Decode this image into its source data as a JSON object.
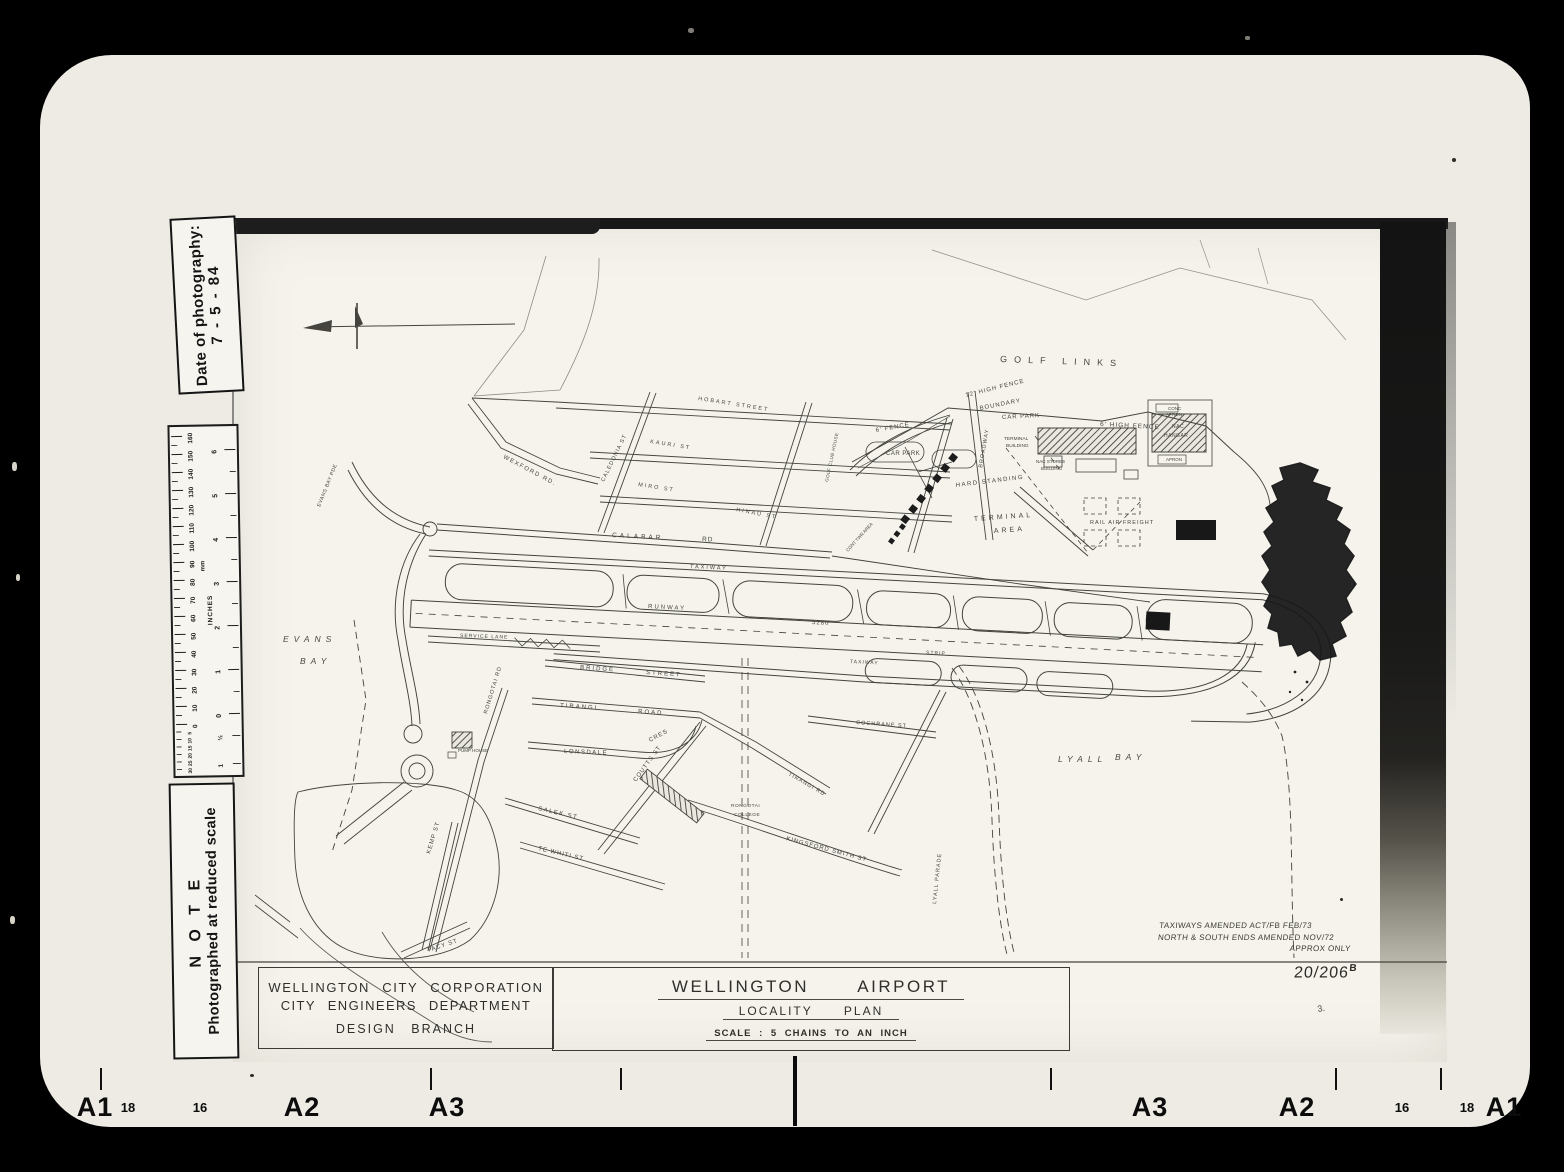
{
  "photo": {
    "date_sticker": {
      "line1": "Date of photography:",
      "line2": "7 - 5 - 84"
    },
    "note_sticker": {
      "line1": "N O T E",
      "line2": "Photographed at reduced scale"
    },
    "ruler": {
      "unit_left": "mm",
      "unit_right": "INCHES",
      "mm_labels": [
        160,
        150,
        140,
        130,
        120,
        110,
        100,
        90,
        80,
        70,
        60,
        50,
        40,
        30,
        20,
        10,
        0
      ],
      "mm_extra": [
        5,
        10,
        15,
        20,
        25,
        30
      ],
      "inch_labels": [
        6,
        5,
        4,
        3,
        2,
        1,
        0
      ],
      "inch_extra": [
        "½",
        "1"
      ]
    },
    "edge_markers": [
      {
        "text": "A1",
        "x": 95,
        "big": true
      },
      {
        "text": "18",
        "x": 128,
        "big": false
      },
      {
        "text": "16",
        "x": 200,
        "big": false
      },
      {
        "text": "A2",
        "x": 302,
        "big": true
      },
      {
        "text": "A3",
        "x": 447,
        "big": true
      },
      {
        "text": "A3",
        "x": 1150,
        "big": true
      },
      {
        "text": "A2",
        "x": 1297,
        "big": true
      },
      {
        "text": "16",
        "x": 1402,
        "big": false
      },
      {
        "text": "18",
        "x": 1467,
        "big": false
      },
      {
        "text": "A1",
        "x": 1504,
        "big": true
      }
    ]
  },
  "title_block": {
    "org_line1": "WELLINGTON CITY CORPORATION",
    "org_line2": "CITY ENGINEERS DEPARTMENT",
    "org_line3": "DESIGN BRANCH",
    "title": "WELLINGTON AIRPORT",
    "subtitle": "LOCALITY PLAN",
    "scale": "SCALE : 5 CHAINS TO AN INCH",
    "drawing_number": "20/206",
    "drawing_rev": "B",
    "amendment_1": "TAXIWAYS AMENDED ACT/FB FEB/73",
    "amendment_2": "NORTH & SOUTH ENDS AMENDED NOV/72",
    "amendment_3": "APPROX ONLY"
  },
  "map": {
    "labels": [
      {
        "t": "GOLF LINKS",
        "x": 1000,
        "y": 362,
        "r": 2,
        "s": 9,
        "ls": 7
      },
      {
        "t": "12' HIGH FENCE",
        "x": 966,
        "y": 397,
        "r": -14,
        "s": 6,
        "ls": 1
      },
      {
        "t": "BOUNDARY",
        "x": 980,
        "y": 410,
        "r": -11,
        "s": 6,
        "ls": 1
      },
      {
        "t": "CAR PARK",
        "x": 1002,
        "y": 419,
        "r": -3,
        "s": 6,
        "ls": 1
      },
      {
        "t": "6' FENCE",
        "x": 876,
        "y": 432,
        "r": -10,
        "s": 6,
        "ls": 1
      },
      {
        "t": "CAR PARK",
        "x": 886,
        "y": 455,
        "r": 0,
        "s": 6,
        "ls": 0.5
      },
      {
        "t": "6' HIGH FENCE",
        "x": 1100,
        "y": 426,
        "r": 3,
        "s": 6.5,
        "ls": 1
      },
      {
        "t": "CONC",
        "x": 1168,
        "y": 410,
        "r": 0,
        "s": 4.5,
        "ls": 0
      },
      {
        "t": "APRON",
        "x": 1166,
        "y": 416,
        "r": 0,
        "s": 4.5,
        "ls": 0
      },
      {
        "t": "NAC",
        "x": 1172,
        "y": 428,
        "r": 0,
        "s": 5,
        "ls": 0.5
      },
      {
        "t": "HANGAR",
        "x": 1164,
        "y": 437,
        "r": 0,
        "s": 5,
        "ls": 0.5
      },
      {
        "t": "APRON",
        "x": 1166,
        "y": 461,
        "r": 0,
        "s": 4.5,
        "ls": 0
      },
      {
        "t": "TERMINAL",
        "x": 1004,
        "y": 440,
        "r": 0,
        "s": 4.8,
        "ls": 0
      },
      {
        "t": "BUILDING",
        "x": 1006,
        "y": 447,
        "r": 0,
        "s": 4.8,
        "ls": 0
      },
      {
        "t": "NAC STORES",
        "x": 1036,
        "y": 463,
        "r": 0,
        "s": 4.5,
        "ls": 0
      },
      {
        "t": "BUILDING",
        "x": 1041,
        "y": 470,
        "r": 0,
        "s": 4.5,
        "ls": 0
      },
      {
        "t": "HARD STANDING",
        "x": 956,
        "y": 487,
        "r": -7,
        "s": 6,
        "ls": 1.5
      },
      {
        "t": "TERMINAL",
        "x": 974,
        "y": 521,
        "r": -4,
        "s": 7,
        "ls": 3
      },
      {
        "t": "AREA",
        "x": 994,
        "y": 533,
        "r": -4,
        "s": 7,
        "ls": 3
      },
      {
        "t": "RAIL AIR FREIGHT",
        "x": 1090,
        "y": 524,
        "r": 0,
        "s": 5.5,
        "ls": 1
      },
      {
        "t": "GOLF CLUB HOUSE",
        "x": 828,
        "y": 482,
        "r": -78,
        "s": 4.5,
        "ls": 0.5
      },
      {
        "t": "CONT TWR AREA",
        "x": 848,
        "y": 552,
        "r": -48,
        "s": 4.5,
        "ls": 0
      },
      {
        "t": "CALABAR",
        "x": 612,
        "y": 537,
        "r": 3,
        "s": 6.5,
        "ls": 3
      },
      {
        "t": "RD",
        "x": 702,
        "y": 541,
        "r": 3,
        "s": 6.5,
        "ls": 1
      },
      {
        "t": "TAXIWAY",
        "x": 690,
        "y": 568,
        "r": 3,
        "s": 5.5,
        "ls": 2
      },
      {
        "t": "RUNWAY",
        "x": 648,
        "y": 608,
        "r": 3,
        "s": 6,
        "ls": 2
      },
      {
        "t": "5280",
        "x": 812,
        "y": 624,
        "r": 3,
        "s": 6,
        "ls": 1
      },
      {
        "t": "TAXIWAY",
        "x": 850,
        "y": 663,
        "r": 3,
        "s": 5,
        "ls": 1
      },
      {
        "t": "STRIP",
        "x": 926,
        "y": 654,
        "r": 3,
        "s": 5,
        "ls": 1
      },
      {
        "t": "EVANS",
        "x": 283,
        "y": 642,
        "r": 0,
        "s": 8.5,
        "ls": 5,
        "i": true
      },
      {
        "t": "BAY",
        "x": 300,
        "y": 664,
        "r": 0,
        "s": 8.5,
        "ls": 5,
        "i": true
      },
      {
        "t": "LYALL",
        "x": 1058,
        "y": 762,
        "r": 0,
        "s": 8.5,
        "ls": 5,
        "i": true
      },
      {
        "t": "BAY",
        "x": 1115,
        "y": 760,
        "r": 0,
        "s": 8.5,
        "ls": 5,
        "i": true
      },
      {
        "t": "SERVICE LANE",
        "x": 460,
        "y": 637,
        "r": 2,
        "s": 5,
        "ls": 1
      },
      {
        "t": "BRIDGE",
        "x": 580,
        "y": 669,
        "r": 4,
        "s": 6,
        "ls": 2
      },
      {
        "t": "STREET",
        "x": 646,
        "y": 674,
        "r": 4,
        "s": 6,
        "ls": 2
      },
      {
        "t": "TIRANGI",
        "x": 560,
        "y": 707,
        "r": 4,
        "s": 6,
        "ls": 2
      },
      {
        "t": "ROAD",
        "x": 638,
        "y": 713,
        "r": 4,
        "s": 6,
        "ls": 2
      },
      {
        "t": "LONSDALE",
        "x": 564,
        "y": 753,
        "r": 2,
        "s": 6,
        "ls": 1.5
      },
      {
        "t": "CRES",
        "x": 650,
        "y": 742,
        "r": -28,
        "s": 6,
        "ls": 1
      },
      {
        "t": "COUTTS ST",
        "x": 636,
        "y": 782,
        "r": -54,
        "s": 6,
        "ls": 1
      },
      {
        "t": "SALEK ST",
        "x": 538,
        "y": 810,
        "r": 13,
        "s": 6,
        "ls": 1.5
      },
      {
        "t": "TE WHITI ST",
        "x": 538,
        "y": 850,
        "r": 13,
        "s": 6,
        "ls": 1
      },
      {
        "t": "KEMP ST",
        "x": 430,
        "y": 854,
        "r": -73,
        "s": 6,
        "ls": 1
      },
      {
        "t": "TACY ST",
        "x": 428,
        "y": 952,
        "r": -18,
        "s": 6,
        "ls": 1
      },
      {
        "t": "RONGOTAI RD",
        "x": 487,
        "y": 714,
        "r": -73,
        "s": 5.5,
        "ls": 1
      },
      {
        "t": "RONGOTAI",
        "x": 731,
        "y": 807,
        "r": 0,
        "s": 4.8,
        "ls": 0.5
      },
      {
        "t": "COLLEGE",
        "x": 734,
        "y": 816,
        "r": 0,
        "s": 4.8,
        "ls": 0.5
      },
      {
        "t": "KINGSFORD SMITH ST",
        "x": 786,
        "y": 840,
        "r": 15,
        "s": 6,
        "ls": 1
      },
      {
        "t": "COCHRANE ST",
        "x": 856,
        "y": 724,
        "r": 4,
        "s": 5.5,
        "ls": 1
      },
      {
        "t": "TIRANGI RD",
        "x": 788,
        "y": 775,
        "r": 30,
        "s": 5.5,
        "ls": 1
      },
      {
        "t": "LYALL PARADE",
        "x": 936,
        "y": 904,
        "r": -84,
        "s": 5.5,
        "ls": 1
      },
      {
        "t": "PUMP HOUSE",
        "x": 458,
        "y": 752,
        "r": 0,
        "s": 4.5,
        "ls": 0
      },
      {
        "t": "WEXFORD RD.",
        "x": 503,
        "y": 458,
        "r": 28,
        "s": 6,
        "ls": 1.5
      },
      {
        "t": "CALEDONIA ST",
        "x": 604,
        "y": 482,
        "r": -64,
        "s": 5.5,
        "ls": 1
      },
      {
        "t": "HOBART STREET",
        "x": 698,
        "y": 400,
        "r": 9,
        "s": 5.5,
        "ls": 2
      },
      {
        "t": "KAURI ST",
        "x": 650,
        "y": 443,
        "r": 9,
        "s": 5.5,
        "ls": 2
      },
      {
        "t": "MIRO ST",
        "x": 638,
        "y": 486,
        "r": 9,
        "s": 5.5,
        "ls": 2
      },
      {
        "t": "HINAU ST",
        "x": 736,
        "y": 511,
        "r": 11,
        "s": 5.5,
        "ls": 2
      },
      {
        "t": "BROADWAY",
        "x": 982,
        "y": 468,
        "r": -80,
        "s": 5.5,
        "ls": 1
      },
      {
        "t": "EVANS BAY PDE",
        "x": 320,
        "y": 507,
        "r": -68,
        "s": 5,
        "ls": 0.5
      },
      {
        "t": "3.",
        "x": 1318,
        "y": 1012,
        "r": -10,
        "s": 9,
        "ls": 0
      }
    ]
  }
}
